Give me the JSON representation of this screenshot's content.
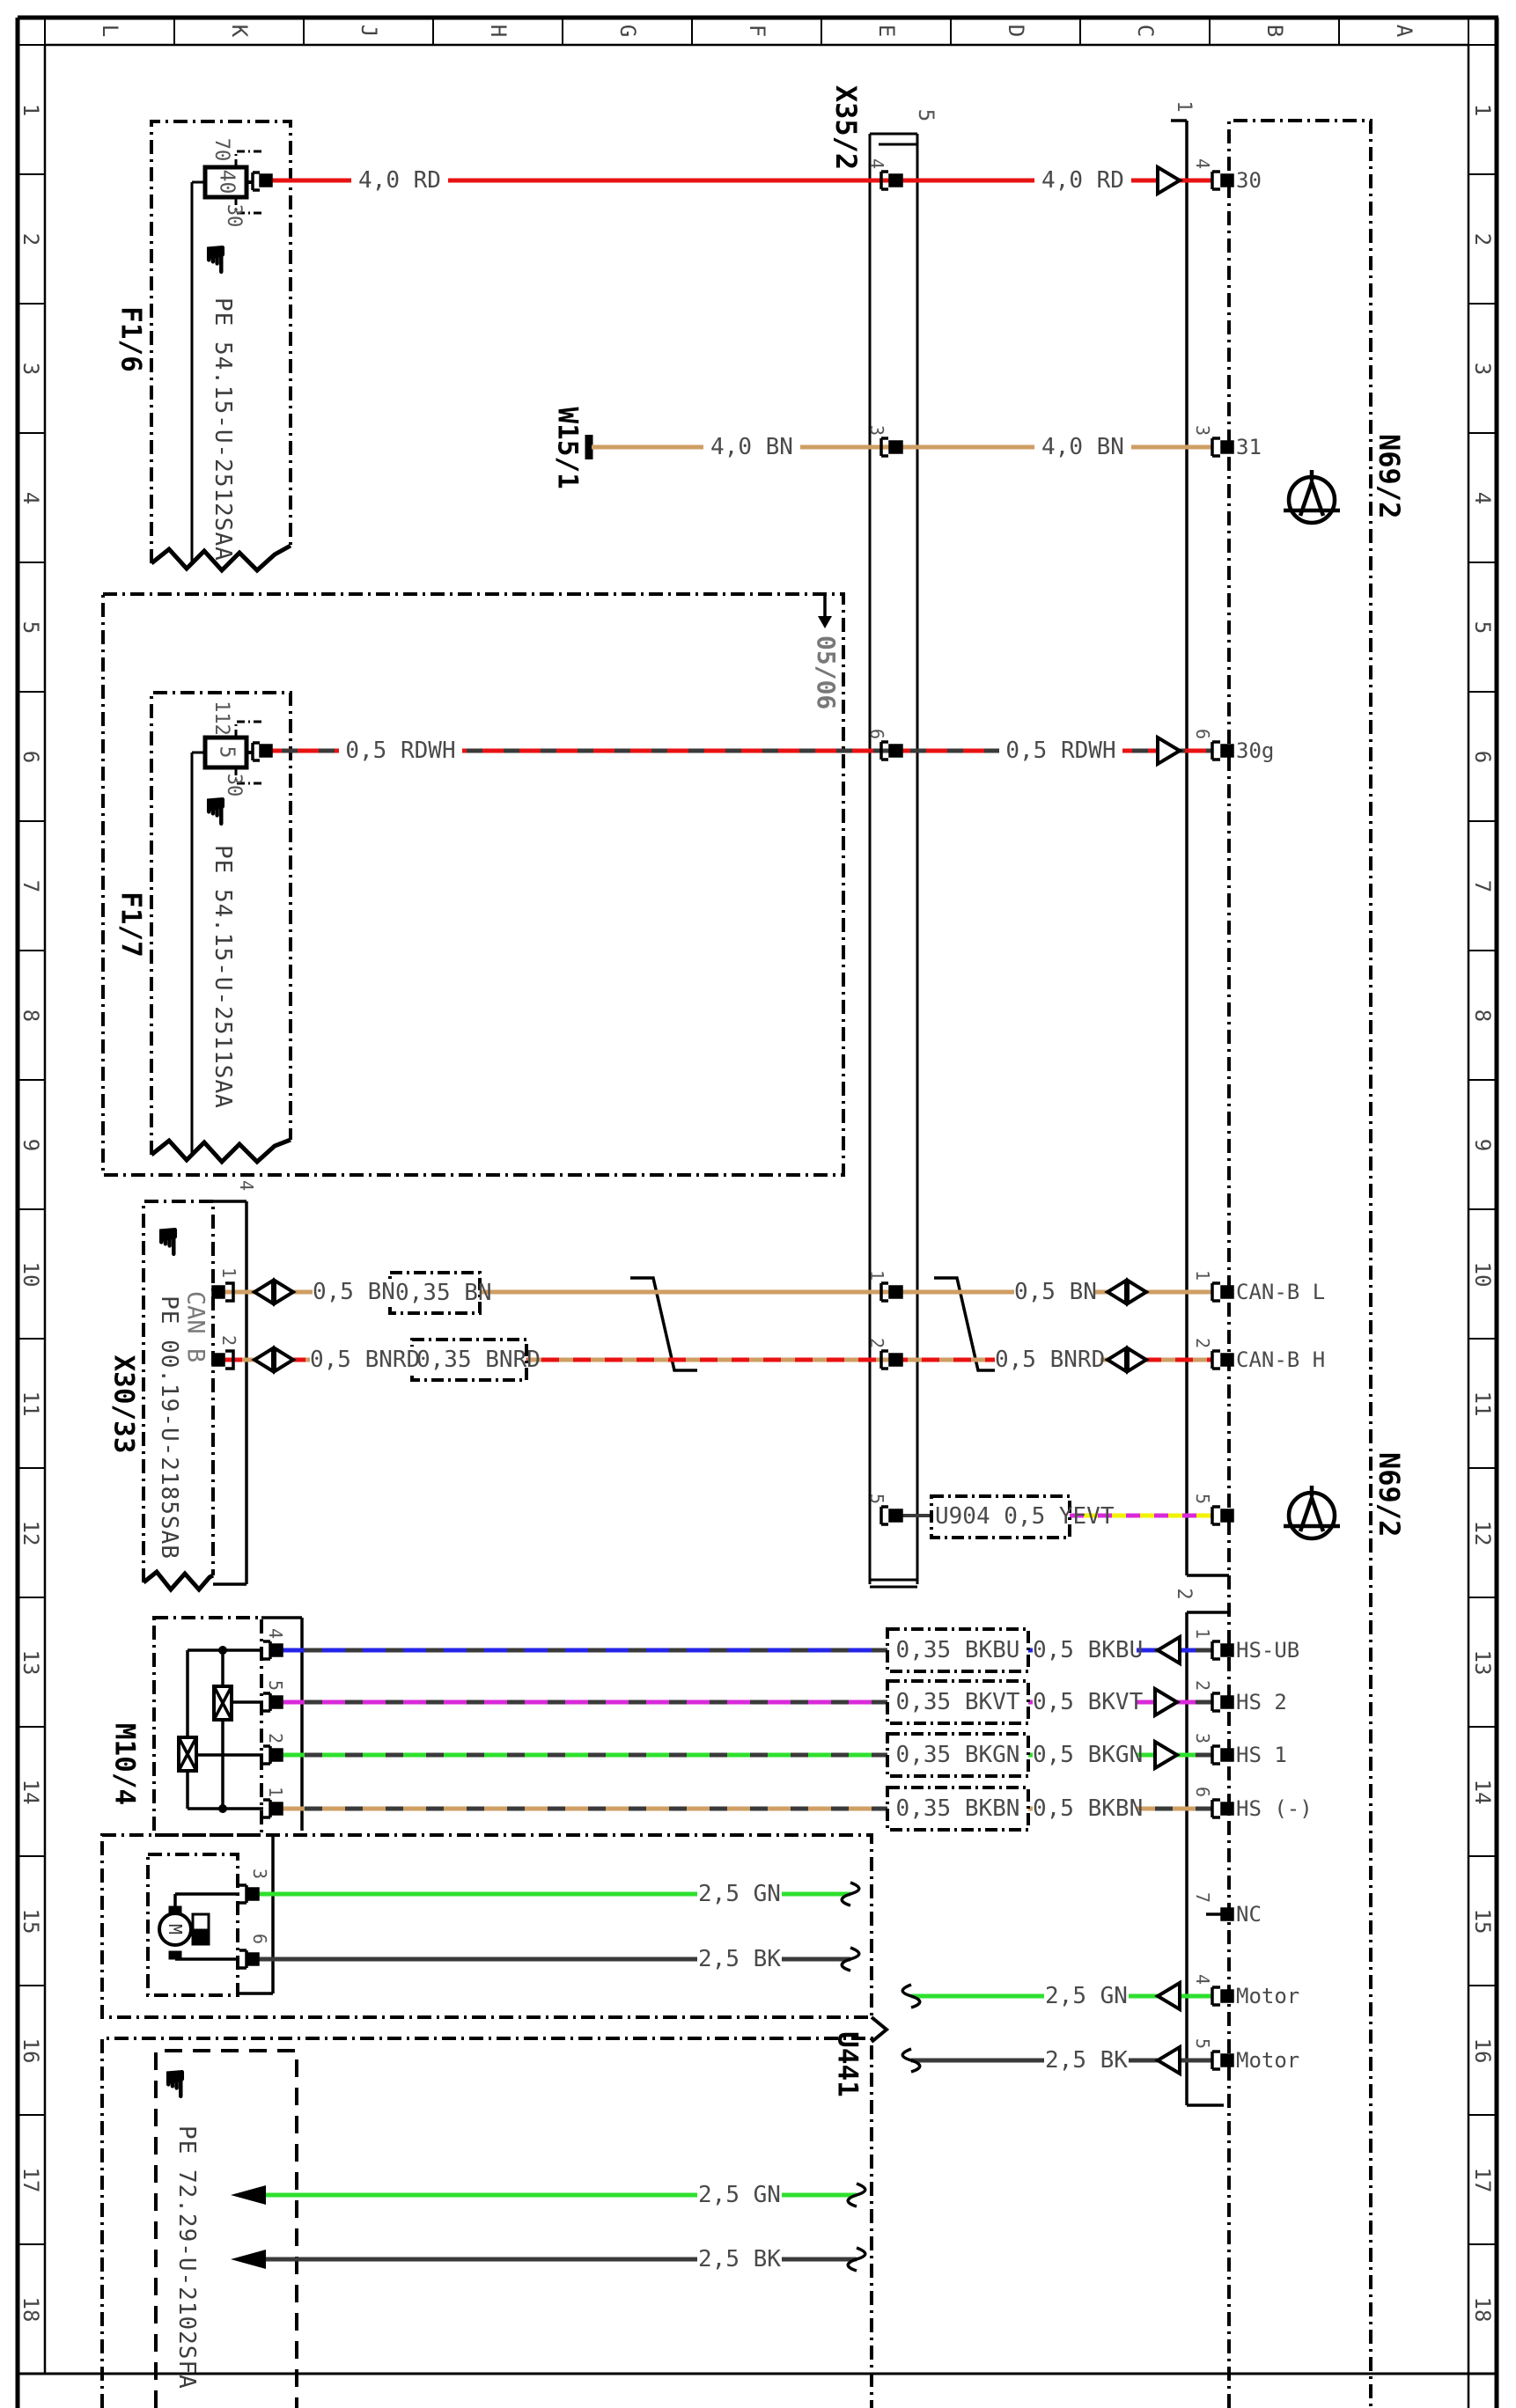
{
  "diagram": {
    "grid": {
      "letters": [
        "L",
        "K",
        "J",
        "H",
        "G",
        "F",
        "E",
        "D",
        "C",
        "B",
        "A"
      ],
      "rows": [
        "1",
        "2",
        "3",
        "4",
        "5",
        "6",
        "7",
        "8",
        "9",
        "10",
        "11",
        "12",
        "13",
        "14",
        "15",
        "16",
        "17",
        "18"
      ]
    },
    "variant_marker": "05/06",
    "components": {
      "f1_6": {
        "id": "F1/6",
        "rating": "40",
        "term_top": "70",
        "term_bottom": "30",
        "pe": "PE 54.15-U-2512SAA"
      },
      "f1_7": {
        "id": "F1/7",
        "rating": "5",
        "term_top": "112",
        "term_bottom": "30",
        "pe": "PE 54.15-U-2511SAA"
      },
      "w15_1": {
        "id": "W15/1"
      },
      "x35_2": {
        "id": "X35/2",
        "connector": "5",
        "pin_numbers": [
          "4",
          "3",
          "6",
          "1",
          "2",
          "5"
        ]
      },
      "x30_33": {
        "id": "X30/33",
        "bus": "CAN B",
        "pe": "PE 00.19-U-2185SAB",
        "connector": "4",
        "pin_numbers": [
          "1",
          "2"
        ]
      },
      "m10_4": {
        "id": "M10/4",
        "motor_letter": "M",
        "valve_pins": [
          "4",
          "5",
          "2",
          "1"
        ],
        "motor_pins": [
          "3",
          "6"
        ]
      },
      "u441": {
        "id": "U441",
        "pe": "PE 72.29-U-2102SFA"
      },
      "n69_2": {
        "id": "N69/2",
        "id2": "N69/2",
        "connector1": "1",
        "connector2": "2",
        "conn1_pins": [
          {
            "num": "4",
            "signal": "30"
          },
          {
            "num": "3",
            "signal": "31"
          },
          {
            "num": "6",
            "signal": "30g"
          },
          {
            "num": "1",
            "signal": "CAN-B L"
          },
          {
            "num": "2",
            "signal": "CAN-B H"
          },
          {
            "num": "5",
            "signal": ""
          }
        ],
        "conn2_pins": [
          {
            "num": "1",
            "signal": "HS-UB"
          },
          {
            "num": "2",
            "signal": "HS 2"
          },
          {
            "num": "3",
            "signal": "HS 1"
          },
          {
            "num": "6",
            "signal": "HS (-)"
          },
          {
            "num": "7",
            "signal": "NC"
          },
          {
            "num": "4",
            "signal": "Motor"
          },
          {
            "num": "5",
            "signal": "Motor"
          }
        ]
      }
    },
    "wire_labels": {
      "rd_left": "4,0 RD",
      "rd_right": "4,0 RD",
      "bn_left": "4,0 BN",
      "bn_right": "4,0 BN",
      "rdwh_left": "0,5 RDWH",
      "rdwh_right": "0,5 RDWH",
      "canl_left": "0,5 BN",
      "canl_small": "0,35 BN",
      "canl_right": "0,5 BN",
      "canh_left": "0,5 BNRD",
      "canh_small": "0,35 BNRD",
      "canh_right": "0,5 BNRD",
      "u904": "U904 0,5 YEVT",
      "hs_ub_small": "0,35 BKBU",
      "hs_ub": "0,5 BKBU",
      "hs2_small": "0,35 BKVT",
      "hs2": "0,5 BKVT",
      "hs1_small": "0,35 BKGN",
      "hs1": "0,5 BKGN",
      "hsm_small": "0,35 BKBN",
      "hsm": "0,5 BKBN",
      "gn_left": "2,5 GN",
      "bk_left": "2,5 BK",
      "gn_right": "2,5 GN",
      "bk_right": "2,5 BK",
      "gn_bottom": "2,5 GN",
      "bk_bottom": "2,5 BK"
    },
    "colors": {
      "red": "#e81212",
      "brown": "#cf9e63",
      "green": "#2ee02e",
      "blue": "#2525e8",
      "violet": "#d929d9",
      "yellow": "#f2f200",
      "black_wire": "#3a3a3a"
    }
  }
}
